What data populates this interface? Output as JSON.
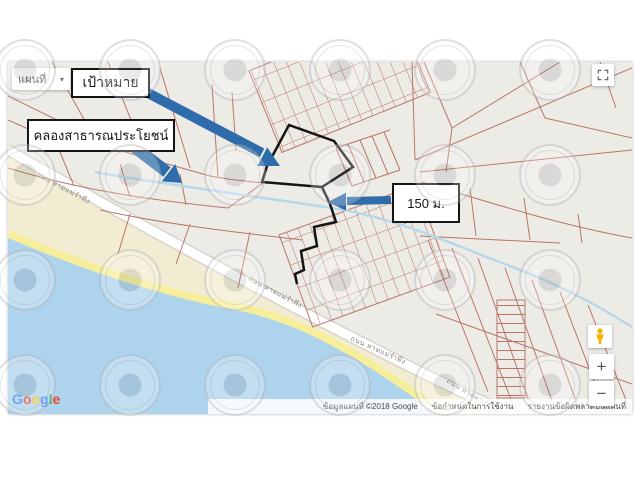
{
  "map_controls": {
    "map_type_label": "แผนที่",
    "dropdown_caret": "▾",
    "zoom_in": "+",
    "zoom_out": "−"
  },
  "annotations": {
    "target": "เป้าหมาย",
    "canal": "คลองสาธารณประโยชน์",
    "distance": "150 ม."
  },
  "map": {
    "road_name": "ถนน หาดแม่รำพึง"
  },
  "attribution": {
    "map_data": "ข้อมูลแผนที่ ©2018 Google",
    "terms": "ข้อกำหนดในการใช้งาน",
    "report": "รายงานข้อผิดพลาดบนแผนที่"
  },
  "branding": {
    "logo_letters": [
      {
        "ch": "G",
        "color": "#4285F4"
      },
      {
        "ch": "o",
        "color": "#EA4335"
      },
      {
        "ch": "o",
        "color": "#FBBC05"
      },
      {
        "ch": "g",
        "color": "#4285F4"
      },
      {
        "ch": "l",
        "color": "#34A853"
      },
      {
        "ch": "e",
        "color": "#EA4335"
      }
    ]
  },
  "colors": {
    "land": "#edebe6",
    "sea": "#aed3ec",
    "sand": "#f2edd2",
    "shoreline_highlight": "#f6ee9b",
    "parcel_line": "#b4685c",
    "canal_line": "#b7d8e9",
    "annotation_arrow": "#2f6cab",
    "target_outline": "#141414"
  }
}
